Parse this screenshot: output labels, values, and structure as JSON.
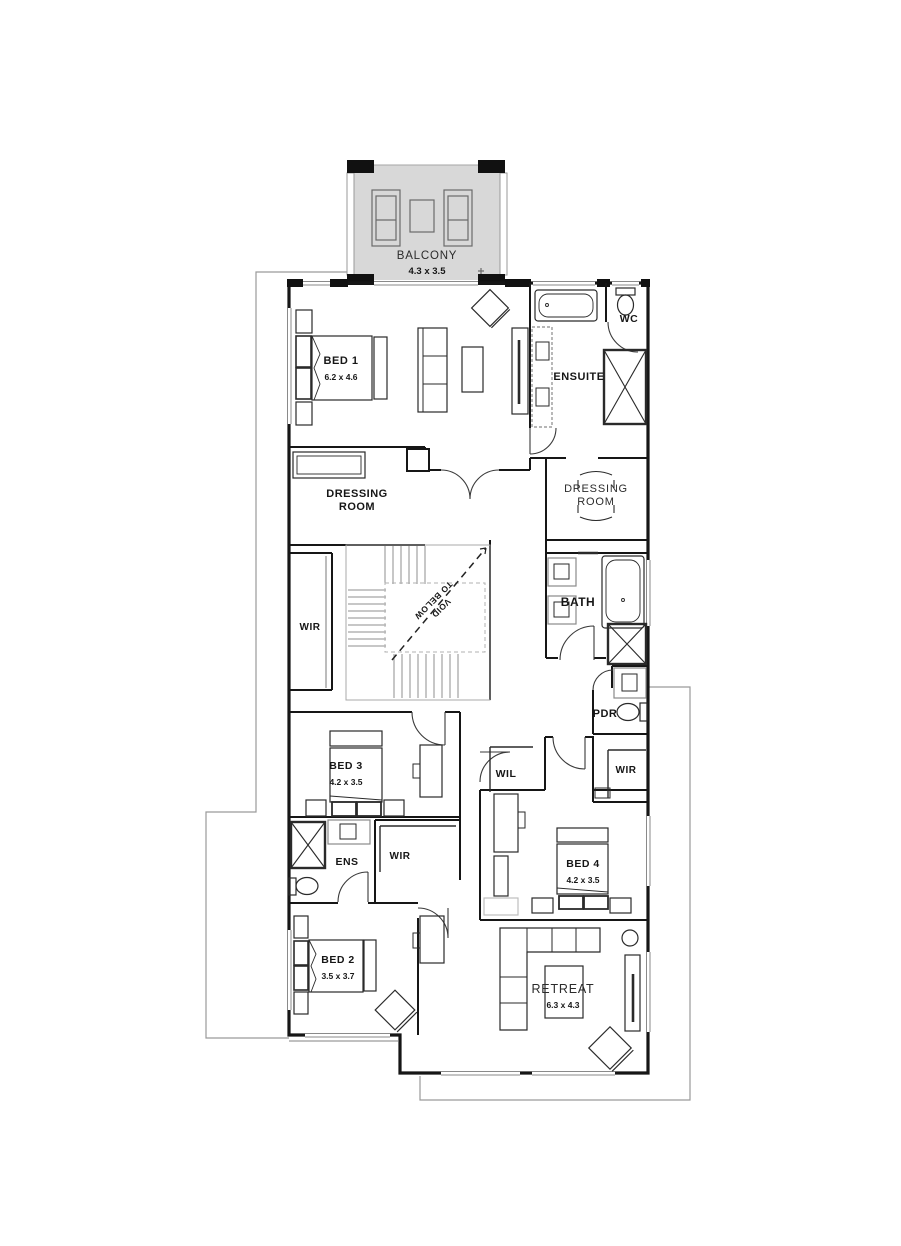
{
  "balcony": {
    "label": "BALCONY",
    "dims": "4.3 x 3.5"
  },
  "rooms": {
    "bed1": {
      "label": "BED 1",
      "dims": "6.2 x 4.6"
    },
    "ensuite": {
      "label": "ENSUITE"
    },
    "wc": {
      "label": "WC"
    },
    "dressing_left": {
      "line1": "DRESSING",
      "line2": "ROOM"
    },
    "dressing_right": {
      "line1": "DRESSING",
      "line2": "ROOM"
    },
    "wir_left": {
      "label": "WIR"
    },
    "void": {
      "line1": "VOID",
      "line2": "TO BELOW"
    },
    "bath": {
      "label": "BATH"
    },
    "pdr": {
      "label": "PDR"
    },
    "wir_right": {
      "label": "WIR"
    },
    "bed3": {
      "label": "BED 3",
      "dims": "4.2 x 3.5"
    },
    "wil": {
      "label": "WIL"
    },
    "ens": {
      "label": "ENS"
    },
    "wir_mid": {
      "label": "WIR"
    },
    "bed4": {
      "label": "BED 4",
      "dims": "4.2 x 3.5"
    },
    "bed2": {
      "label": "BED 2",
      "dims": "3.5 x 3.7"
    },
    "retreat": {
      "label": "RETREAT",
      "dims": "6.3 x 4.3"
    }
  },
  "colors": {
    "wall": "#161616",
    "outline": "#9a9a9a",
    "balcony_fill": "#d8d8d8"
  }
}
